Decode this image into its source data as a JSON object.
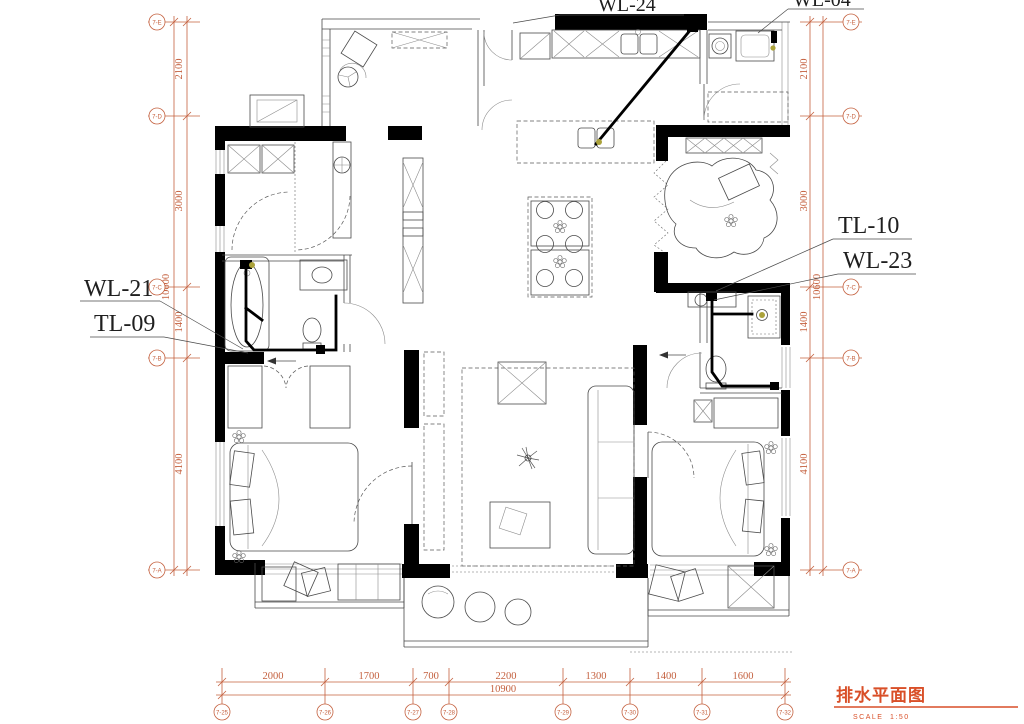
{
  "title": {
    "text": "排水平面图",
    "scale_label": "SCALE",
    "scale_value": "1:50"
  },
  "labels": {
    "kitchen_waste": "WL-24",
    "utility_waste": "WL-04",
    "left_bath_waste": "WL-21",
    "left_bath_vent": "TL-09",
    "right_bath_vent": "TL-10",
    "right_bath_waste": "WL-23"
  },
  "dimensions": {
    "bottom": {
      "segments": [
        "2000",
        "1700",
        "700",
        "2200",
        "1300",
        "1400",
        "1600"
      ],
      "total": "10900"
    },
    "left": {
      "segments": [
        "2100",
        "3000",
        "1400",
        "4100"
      ],
      "total": "10600"
    },
    "right": {
      "segments": [
        "2100",
        "3000",
        "1400",
        "4100"
      ],
      "total": "10600"
    }
  },
  "grid": {
    "left": [
      "7-E",
      "7-D",
      "7-C",
      "7-B",
      "7-A"
    ],
    "right": [
      "7-E",
      "7-D",
      "7-C",
      "7-B",
      "7-A"
    ],
    "bottom": [
      "7-25",
      "7-26",
      "7-27",
      "7-28",
      "7-29",
      "7-30",
      "7-31",
      "7-32"
    ]
  },
  "colors": {
    "dimension": "#c4603e",
    "title": "#d94f28",
    "wall": "#000000",
    "drain_dot": "#aba23a"
  }
}
